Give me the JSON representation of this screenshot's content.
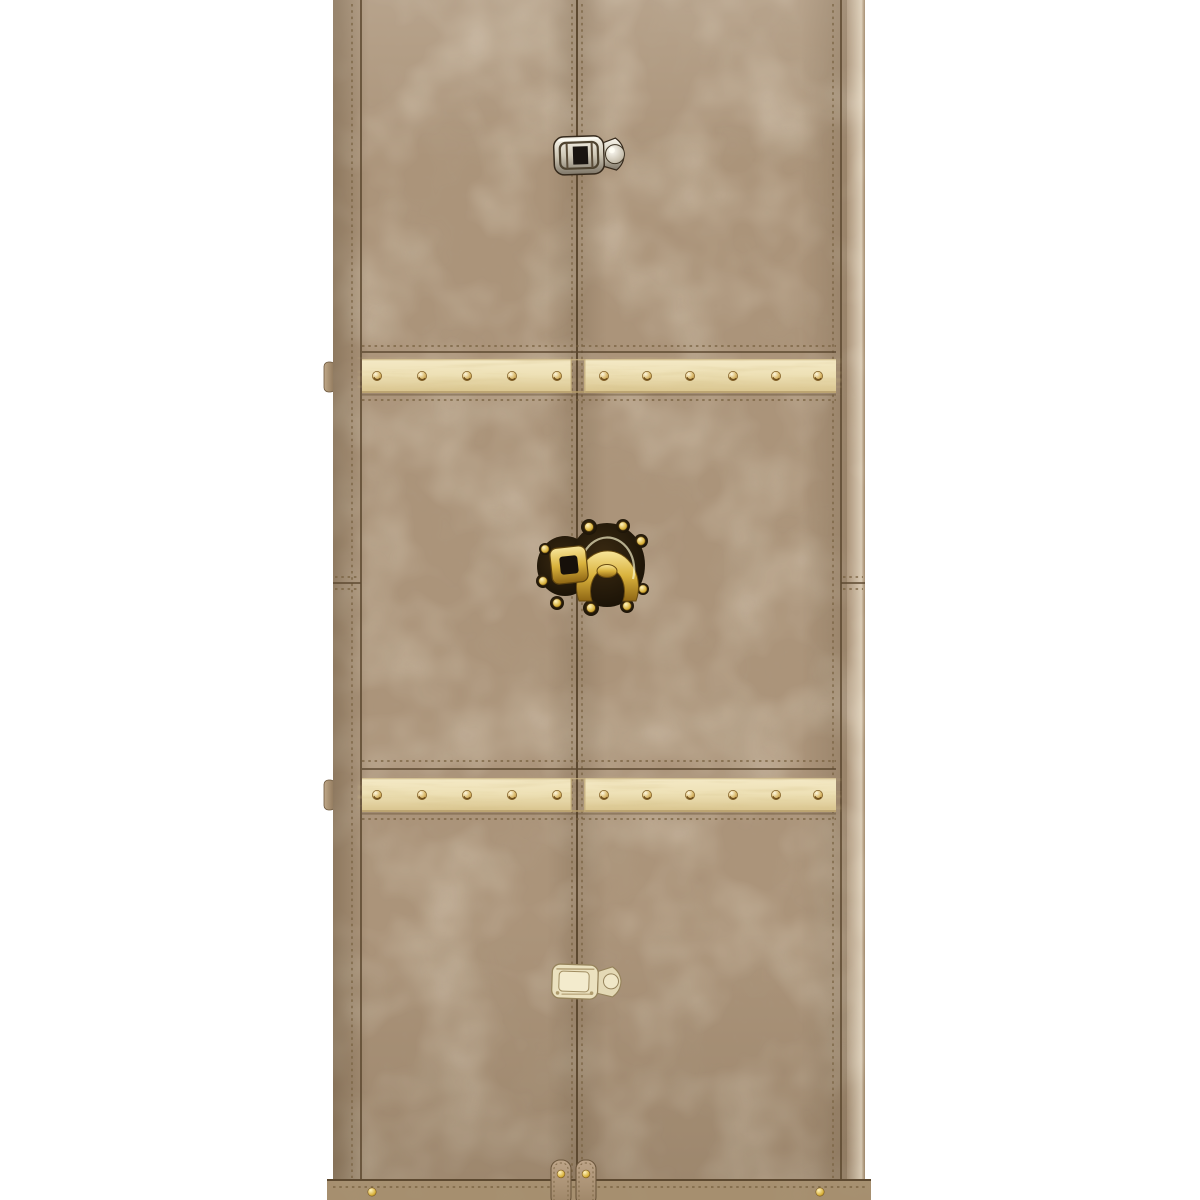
{
  "scene": {
    "type": "product photograph",
    "description": "Tall wardrobe trunk cabinet covered in mottled taupe vintage leather, two front doors with a stitched center seam, chrome top latch, ornate polished-brass middle trunk lock, pale brass bottom latch, two horizontal light-wood slats with brass rivets, leather hinges on the left edge, riveted leather base band with twin straps, photographed on a plain white background, cropped at top and bottom",
    "background_color": "#ffffff"
  },
  "colors": {
    "bg": "#ffffff",
    "leather": "#ab947a",
    "leather_light": "#d6c2a1",
    "leather_dark": "#735c40",
    "band": "#a68f6f",
    "strap": "#b49c7e",
    "seam": "#5d4930",
    "stitch": "#77603f",
    "wood": "#eee1b6",
    "wood_grain": "#a8873f",
    "wood_edge": "#b39a68",
    "gold": "#d9b23c",
    "gold_deep": "#8f6614",
    "plate_dark": "#191006",
    "chrome": "#d9d2c2",
    "chrome_dark": "#35291b",
    "pale_metal": "#ebe1bf",
    "pale_metal_line": "#96835b"
  },
  "trunk": {
    "doors": [
      "left door",
      "right door"
    ],
    "fittings": [
      {
        "name": "top latch",
        "finish": "chrome"
      },
      {
        "name": "middle lock",
        "finish": "polished brass on dark plate"
      },
      {
        "name": "bottom latch",
        "finish": "pale brass"
      }
    ],
    "slats": {
      "count": 2,
      "material": "light pine wood",
      "rivet_finish": "brass",
      "rivets_visible_per_slat": 11
    },
    "hinges_visible": 2,
    "base": {
      "band_rivets_visible": 2,
      "straps": 2,
      "strap_rivets": 2
    }
  }
}
